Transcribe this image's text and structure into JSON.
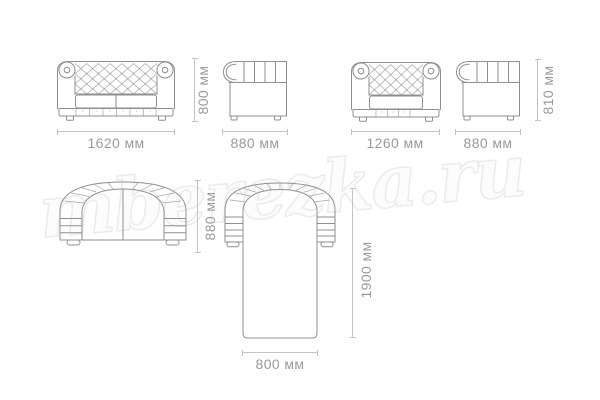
{
  "watermark": {
    "text": "mberezka.ru"
  },
  "colors": {
    "line": "#8f8f8f",
    "detail": "#a5a5a5",
    "dim-line": "#c3c3c3",
    "dim-text": "#9a9a9a",
    "watermark-fill": "#fcfcfc",
    "watermark-stroke": "#ebebeb",
    "background": "#ffffff"
  },
  "views": {
    "sofa_front": {
      "width_label": "1620 мм",
      "height_label": "800 мм"
    },
    "sofa_side": {
      "depth_label": "880 мм"
    },
    "armchair_front": {
      "width_label": "1260 мм"
    },
    "armchair_side": {
      "depth_label": "880 мм",
      "height_label": "810 мм"
    },
    "sofa_top": {
      "depth_label": "880 мм"
    },
    "sofa_unfolded": {
      "bed_length_label": "1900 мм",
      "bed_width_label": "800 мм"
    }
  }
}
